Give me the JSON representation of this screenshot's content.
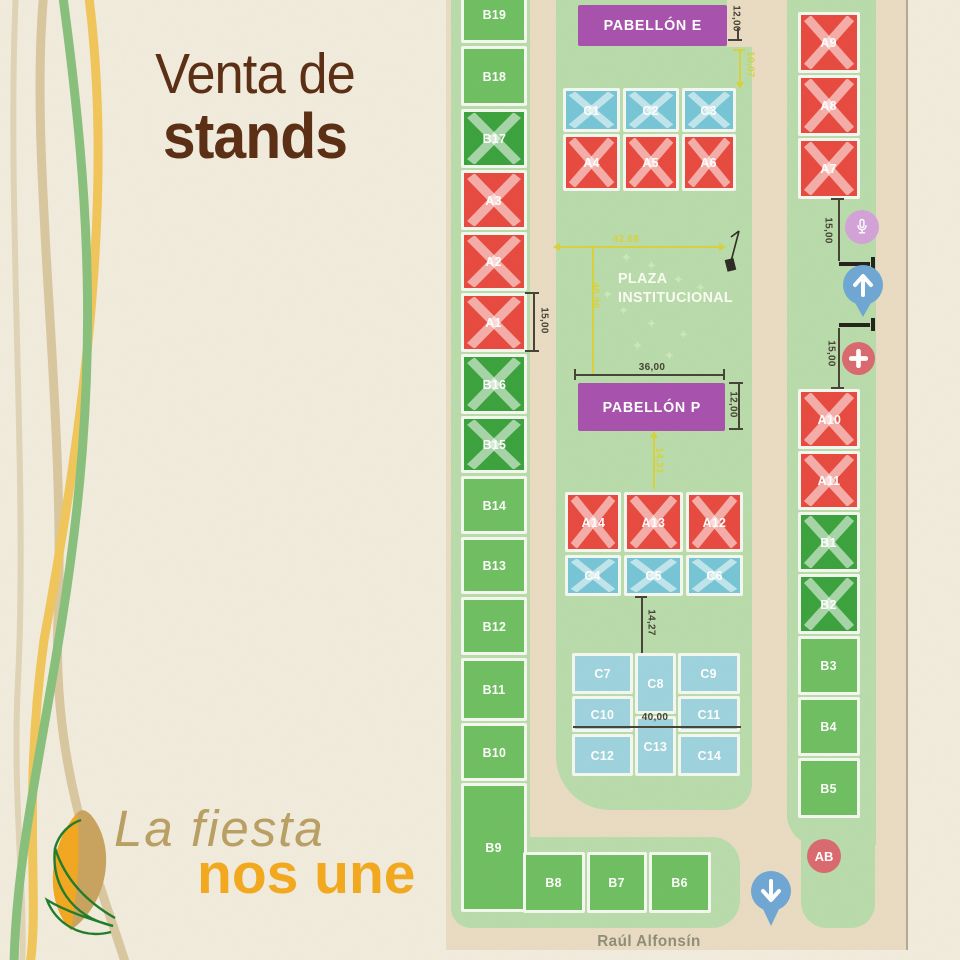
{
  "poster": {
    "title_line1": "Venta de",
    "title_line2": "stands",
    "tagline_line1": "La fiesta",
    "tagline_line2": "nos une"
  },
  "map": {
    "street_label": "Raúl Alfonsín",
    "plaza": {
      "line1": "PLAZA",
      "line2": "INSTITUCIONAL"
    },
    "pavilions": [
      {
        "id": "pabellon-e",
        "label": "PABELLÓN E"
      },
      {
        "id": "pabellon-p",
        "label": "PABELLÓN P"
      }
    ],
    "stands": [
      {
        "id": "B19",
        "label": "B19",
        "status": "available-green"
      },
      {
        "id": "B18",
        "label": "B18",
        "status": "available-green"
      },
      {
        "id": "B17",
        "label": "B17",
        "status": "sold-green-x"
      },
      {
        "id": "A3",
        "label": "A3",
        "status": "sold-red-x"
      },
      {
        "id": "A2",
        "label": "A2",
        "status": "sold-red-x"
      },
      {
        "id": "A1",
        "label": "A1",
        "status": "sold-red-x"
      },
      {
        "id": "B16",
        "label": "B16",
        "status": "sold-green-x"
      },
      {
        "id": "B15",
        "label": "B15",
        "status": "sold-green-x"
      },
      {
        "id": "B14",
        "label": "B14",
        "status": "available-green"
      },
      {
        "id": "B13",
        "label": "B13",
        "status": "available-green"
      },
      {
        "id": "B12",
        "label": "B12",
        "status": "available-green"
      },
      {
        "id": "B11",
        "label": "B11",
        "status": "available-green"
      },
      {
        "id": "B10",
        "label": "B10",
        "status": "available-green"
      },
      {
        "id": "B9",
        "label": "B9",
        "status": "available-green"
      },
      {
        "id": "B8",
        "label": "B8",
        "status": "available-green"
      },
      {
        "id": "B7",
        "label": "B7",
        "status": "available-green"
      },
      {
        "id": "B6",
        "label": "B6",
        "status": "available-green"
      },
      {
        "id": "C1",
        "label": "C1",
        "status": "sold-blue-x"
      },
      {
        "id": "C2",
        "label": "C2",
        "status": "sold-blue-x"
      },
      {
        "id": "C3",
        "label": "C3",
        "status": "sold-blue-x"
      },
      {
        "id": "A4",
        "label": "A4",
        "status": "sold-red-x"
      },
      {
        "id": "A5",
        "label": "A5",
        "status": "sold-red-x"
      },
      {
        "id": "A6",
        "label": "A6",
        "status": "sold-red-x"
      },
      {
        "id": "A14",
        "label": "A14",
        "status": "sold-red-x"
      },
      {
        "id": "A13",
        "label": "A13",
        "status": "sold-red-x"
      },
      {
        "id": "A12",
        "label": "A12",
        "status": "sold-red-x"
      },
      {
        "id": "C4",
        "label": "C4",
        "status": "sold-blue-x"
      },
      {
        "id": "C5",
        "label": "C5",
        "status": "sold-blue-x"
      },
      {
        "id": "C6",
        "label": "C6",
        "status": "sold-blue-x"
      },
      {
        "id": "C7",
        "label": "C7",
        "status": "available-blue"
      },
      {
        "id": "C8",
        "label": "C8",
        "status": "available-blue"
      },
      {
        "id": "C9",
        "label": "C9",
        "status": "available-blue"
      },
      {
        "id": "C10",
        "label": "C10",
        "status": "available-blue"
      },
      {
        "id": "C11",
        "label": "C11",
        "status": "available-blue"
      },
      {
        "id": "C12",
        "label": "C12",
        "status": "available-blue"
      },
      {
        "id": "C13",
        "label": "C13",
        "status": "available-blue"
      },
      {
        "id": "C14",
        "label": "C14",
        "status": "available-blue"
      },
      {
        "id": "A9",
        "label": "A9",
        "status": "sold-red-x"
      },
      {
        "id": "A8",
        "label": "A8",
        "status": "sold-red-x"
      },
      {
        "id": "A7",
        "label": "A7",
        "status": "sold-red-x"
      },
      {
        "id": "A10",
        "label": "A10",
        "status": "sold-red-x"
      },
      {
        "id": "A11",
        "label": "A11",
        "status": "sold-red-x"
      },
      {
        "id": "B1",
        "label": "B1",
        "status": "sold-green-x"
      },
      {
        "id": "B2",
        "label": "B2",
        "status": "sold-green-x"
      },
      {
        "id": "B3",
        "label": "B3",
        "status": "available-green"
      },
      {
        "id": "B4",
        "label": "B4",
        "status": "available-green"
      },
      {
        "id": "B5",
        "label": "B5",
        "status": "available-green"
      }
    ],
    "dimensions": [
      {
        "id": "pabellon-e-height",
        "label": "12,00",
        "color": "dark"
      },
      {
        "id": "gap-pabellon-e-to-c-row",
        "label": "10,07",
        "color": "yellow"
      },
      {
        "id": "plaza-width",
        "label": "42,68",
        "color": "yellow"
      },
      {
        "id": "plaza-height",
        "label": "46,96",
        "color": "yellow"
      },
      {
        "id": "pabellon-p-width",
        "label": "36,00",
        "color": "dark"
      },
      {
        "id": "pabellon-p-height",
        "label": "12,00",
        "color": "dark"
      },
      {
        "id": "gap-pabellon-p-to-a-row",
        "label": "14,31",
        "color": "yellow"
      },
      {
        "id": "gap-c-row-to-c-block",
        "label": "14,27",
        "color": "dark"
      },
      {
        "id": "c-block-width",
        "label": "40,00",
        "color": "dark"
      },
      {
        "id": "stand-a1-height",
        "label": "15,00",
        "color": "dark"
      },
      {
        "id": "north-gate-gap",
        "label": "15,00",
        "color": "dark"
      },
      {
        "id": "south-gate-gap",
        "label": "15,00",
        "color": "dark"
      }
    ],
    "markers": [
      {
        "id": "microphone",
        "icon": "microphone-icon"
      },
      {
        "id": "entrance-north",
        "icon": "arrow-up-pin"
      },
      {
        "id": "first-aid",
        "icon": "plus-icon"
      },
      {
        "id": "entrance-south",
        "icon": "arrow-down-pin"
      },
      {
        "id": "ab-badge",
        "label": "AB"
      }
    ]
  },
  "colors": {
    "paper": "#f1ecdd",
    "road": "#e9dcc3",
    "verge_green": "#b9dcab",
    "pavilion_purple": "#a751ad",
    "dimension_yellow": "#d8d23c",
    "title_brown": "#5a2d13",
    "tagline_tan": "#b99f63",
    "tagline_orange": "#f3a91d",
    "status_sold_red": "#e8493f",
    "status_sold_green": "#3aa23d",
    "status_sold_blue": "#76c5d6",
    "status_available_green": "#6fbf61",
    "status_available_blue": "#9dd3de"
  }
}
